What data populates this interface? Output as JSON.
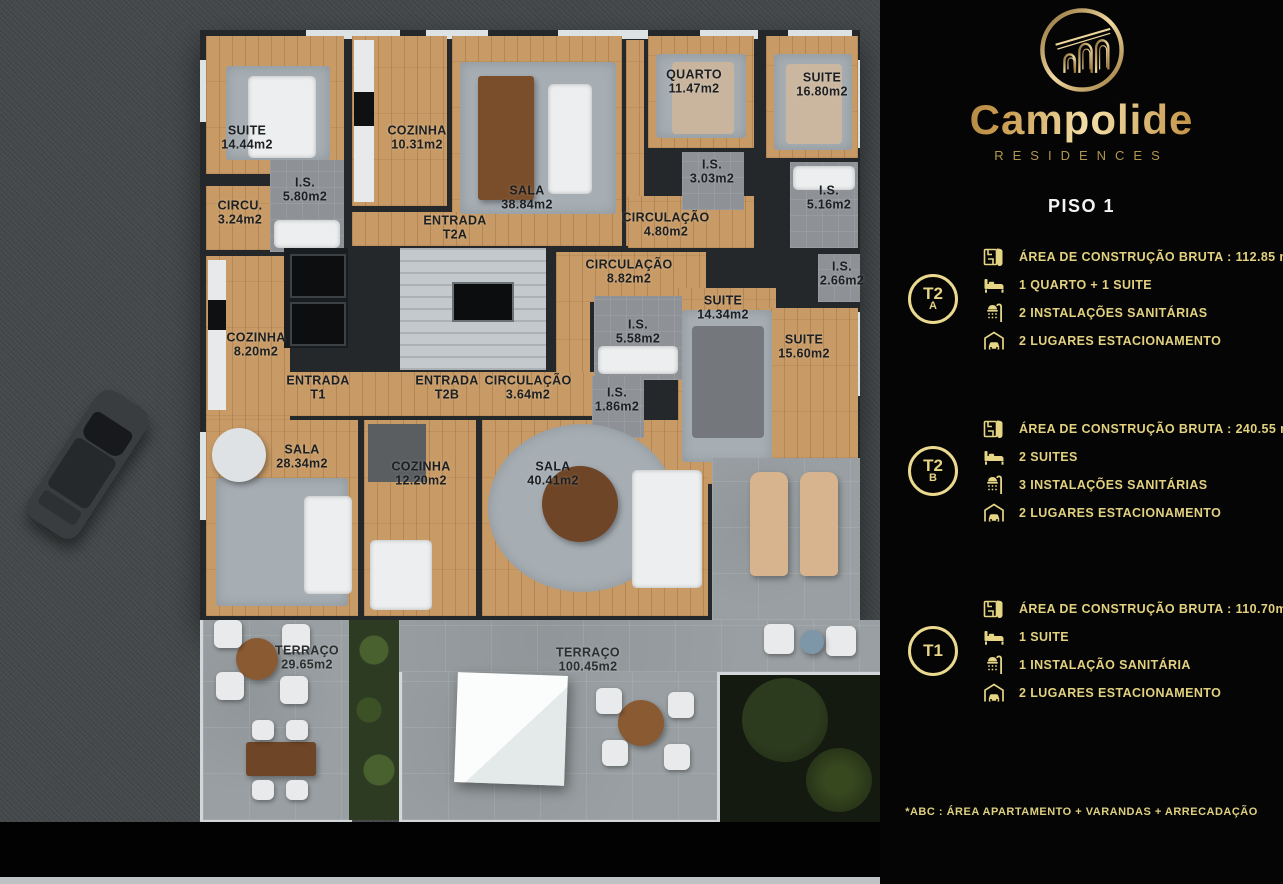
{
  "colors": {
    "panel_bg": "#050505",
    "gold_text": "#e2d17f",
    "badge_ring": "#ead98e",
    "brand_gold_light": "#f3dfa8",
    "brand_gold_dark": "#7a5a28",
    "floor_title_white": "#f4f4f4",
    "wood_floor": "#c89b66",
    "wall": "#24282b",
    "terrace_stone": "#999fa2"
  },
  "brand": {
    "name": "Campolide",
    "sub": "RESIDENCES",
    "logo_icon": "aqueduct-arches-in-circle"
  },
  "panel": {
    "floor_title": "PISO 1",
    "units": [
      {
        "badge_top": "T2",
        "badge_bottom": "A",
        "specs": [
          {
            "icon": "plan-icon",
            "text": "ÁREA DE CONSTRUÇÃO BRUTA :  112.85 m2*"
          },
          {
            "icon": "bed-icon",
            "text": "1 QUARTO + 1 SUITE"
          },
          {
            "icon": "shower-icon",
            "text": "2 INSTALAÇÕES SANITÁRIAS"
          },
          {
            "icon": "garage-icon",
            "text": "2 LUGARES ESTACIONAMENTO"
          }
        ]
      },
      {
        "badge_top": "T2",
        "badge_bottom": "B",
        "specs": [
          {
            "icon": "plan-icon",
            "text": "ÁREA DE CONSTRUÇÃO BRUTA :  240.55 m2*"
          },
          {
            "icon": "bed-icon",
            "text": "2 SUITES"
          },
          {
            "icon": "shower-icon",
            "text": "3 INSTALAÇÕES SANITÁRIAS"
          },
          {
            "icon": "garage-icon",
            "text": "2 LUGARES ESTACIONAMENTO"
          }
        ]
      },
      {
        "badge_top": "T1",
        "badge_bottom": "",
        "specs": [
          {
            "icon": "plan-icon",
            "text": "ÁREA DE CONSTRUÇÃO BRUTA :  110.70m2*"
          },
          {
            "icon": "bed-icon",
            "text": "1 SUITE"
          },
          {
            "icon": "shower-icon",
            "text": "1 INSTALAÇÃO SANITÁRIA"
          },
          {
            "icon": "garage-icon",
            "text": "2 LUGARES ESTACIONAMENTO"
          }
        ]
      }
    ],
    "footnote": "*ABC :  ÁREA APARTAMENTO + VARANDAS + ARRECADAÇÃO"
  },
  "plan": {
    "rooms": [
      {
        "label": "SUITE",
        "area": "14.44m2",
        "x": 247,
        "y": 138
      },
      {
        "label": "COZINHA",
        "area": "10.31m2",
        "x": 417,
        "y": 138
      },
      {
        "label": "I.S.",
        "area": "5.80m2",
        "x": 305,
        "y": 190
      },
      {
        "label": "CIRCU.",
        "area": "3.24m2",
        "x": 240,
        "y": 213
      },
      {
        "label": "ENTRADA",
        "area": "T2A",
        "x": 455,
        "y": 228
      },
      {
        "label": "SALA",
        "area": "38.84m2",
        "x": 527,
        "y": 198
      },
      {
        "label": "CIRCULAÇÃO",
        "area": "4.80m2",
        "x": 666,
        "y": 225
      },
      {
        "label": "QUARTO",
        "area": "11.47m2",
        "x": 694,
        "y": 82
      },
      {
        "label": "I.S.",
        "area": "3.03m2",
        "x": 712,
        "y": 172
      },
      {
        "label": "SUITE",
        "area": "16.80m2",
        "x": 822,
        "y": 85
      },
      {
        "label": "I.S.",
        "area": "5.16m2",
        "x": 829,
        "y": 198
      },
      {
        "label": "CIRCULAÇÃO",
        "area": "8.82m2",
        "x": 629,
        "y": 272
      },
      {
        "label": "I.S.",
        "area": "2.66m2",
        "x": 842,
        "y": 274
      },
      {
        "label": "SUITE",
        "area": "14.34m2",
        "x": 723,
        "y": 308
      },
      {
        "label": "I.S.",
        "area": "5.58m2",
        "x": 638,
        "y": 332
      },
      {
        "label": "SUITE",
        "area": "15.60m2",
        "x": 804,
        "y": 347
      },
      {
        "label": "COZINHA",
        "area": "8.20m2",
        "x": 256,
        "y": 345
      },
      {
        "label": "ENTRADA",
        "area": "T1",
        "x": 318,
        "y": 388
      },
      {
        "label": "ENTRADA",
        "area": "T2B",
        "x": 447,
        "y": 388
      },
      {
        "label": "CIRCULAÇÃO",
        "area": "3.64m2",
        "x": 528,
        "y": 388
      },
      {
        "label": "I.S.",
        "area": "1.86m2",
        "x": 617,
        "y": 400
      },
      {
        "label": "SALA",
        "area": "28.34m2",
        "x": 302,
        "y": 457
      },
      {
        "label": "COZINHA",
        "area": "12.20m2",
        "x": 421,
        "y": 474
      },
      {
        "label": "SALA",
        "area": "40.41m2",
        "x": 553,
        "y": 474
      },
      {
        "label": "TERRAÇO",
        "area": "29.65m2",
        "x": 307,
        "y": 658
      },
      {
        "label": "TERRAÇO",
        "area": "100.45m2",
        "x": 588,
        "y": 660
      }
    ]
  }
}
